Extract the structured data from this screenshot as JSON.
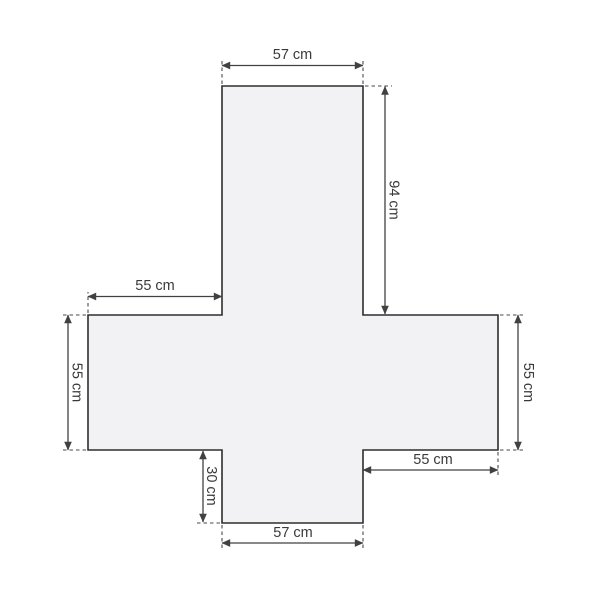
{
  "diagram": {
    "kind": "dimension-drawing",
    "subject": "cross-shaped-cover",
    "unit": "cm",
    "colors": {
      "background": "#ffffff",
      "shape_fill": "#f2f2f4",
      "shape_outline": "#2e2e2e",
      "dimension_lines": "#414141",
      "label_text": "#3a3a3a"
    },
    "labels": {
      "top_width": "57 cm",
      "top_arm_height": "94 cm",
      "left_arm_width": "55 cm",
      "left_side_height": "55 cm",
      "right_side_height": "55 cm",
      "bottom_right_width": "55 cm",
      "bottom_arm_height": "30 cm",
      "bottom_width": "57 cm"
    },
    "measurements": [
      {
        "name": "top-width",
        "value": 57,
        "unit": "cm"
      },
      {
        "name": "top-arm-height",
        "value": 94,
        "unit": "cm"
      },
      {
        "name": "left-arm-width",
        "value": 55,
        "unit": "cm"
      },
      {
        "name": "left-side-height",
        "value": 55,
        "unit": "cm"
      },
      {
        "name": "right-side-height",
        "value": 55,
        "unit": "cm"
      },
      {
        "name": "bottom-right-width",
        "value": 55,
        "unit": "cm"
      },
      {
        "name": "bottom-arm-height",
        "value": 30,
        "unit": "cm"
      },
      {
        "name": "bottom-width",
        "value": 57,
        "unit": "cm"
      }
    ]
  }
}
